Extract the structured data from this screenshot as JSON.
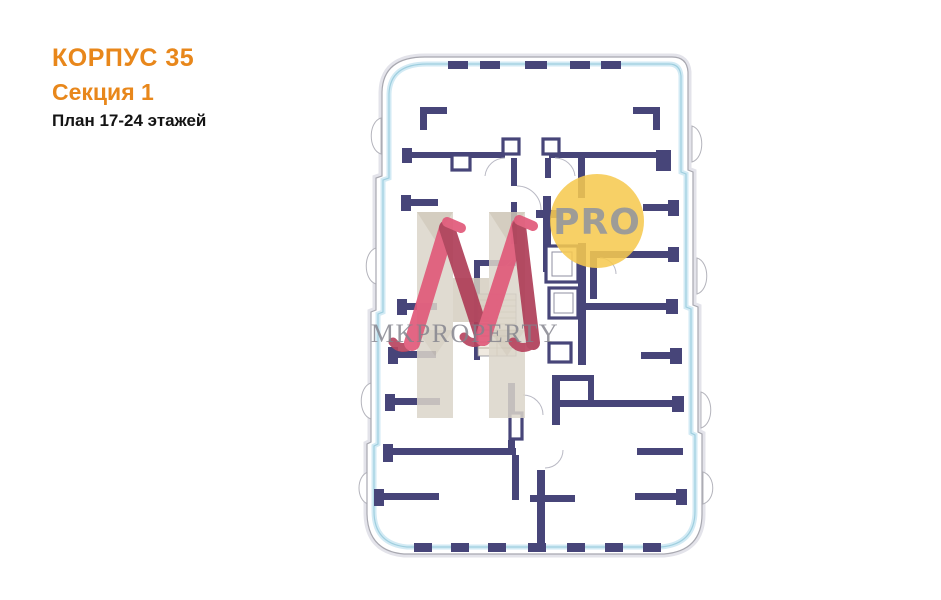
{
  "header": {
    "building": "КОРПУС 35",
    "section": "Секция 1",
    "floors": "План 17-24 этажей"
  },
  "watermarks": {
    "logo_text": "MKPROPERTY",
    "badge_text": "PRO"
  },
  "colors": {
    "accent_orange": "#E8871B",
    "title_black": "#141414",
    "wall_navy": "#474579",
    "window_blue": "#9FCFDF",
    "outline_gray": "#A8A8B0",
    "badge_yellow": "#F6C94F",
    "badge_text_gray": "#9A9A9A",
    "watermark_gray": "#82828C",
    "logo_pink_light": "#E15A7A",
    "logo_pink_dark": "#AF3E58",
    "logo_beige": "#DBD5C9"
  }
}
